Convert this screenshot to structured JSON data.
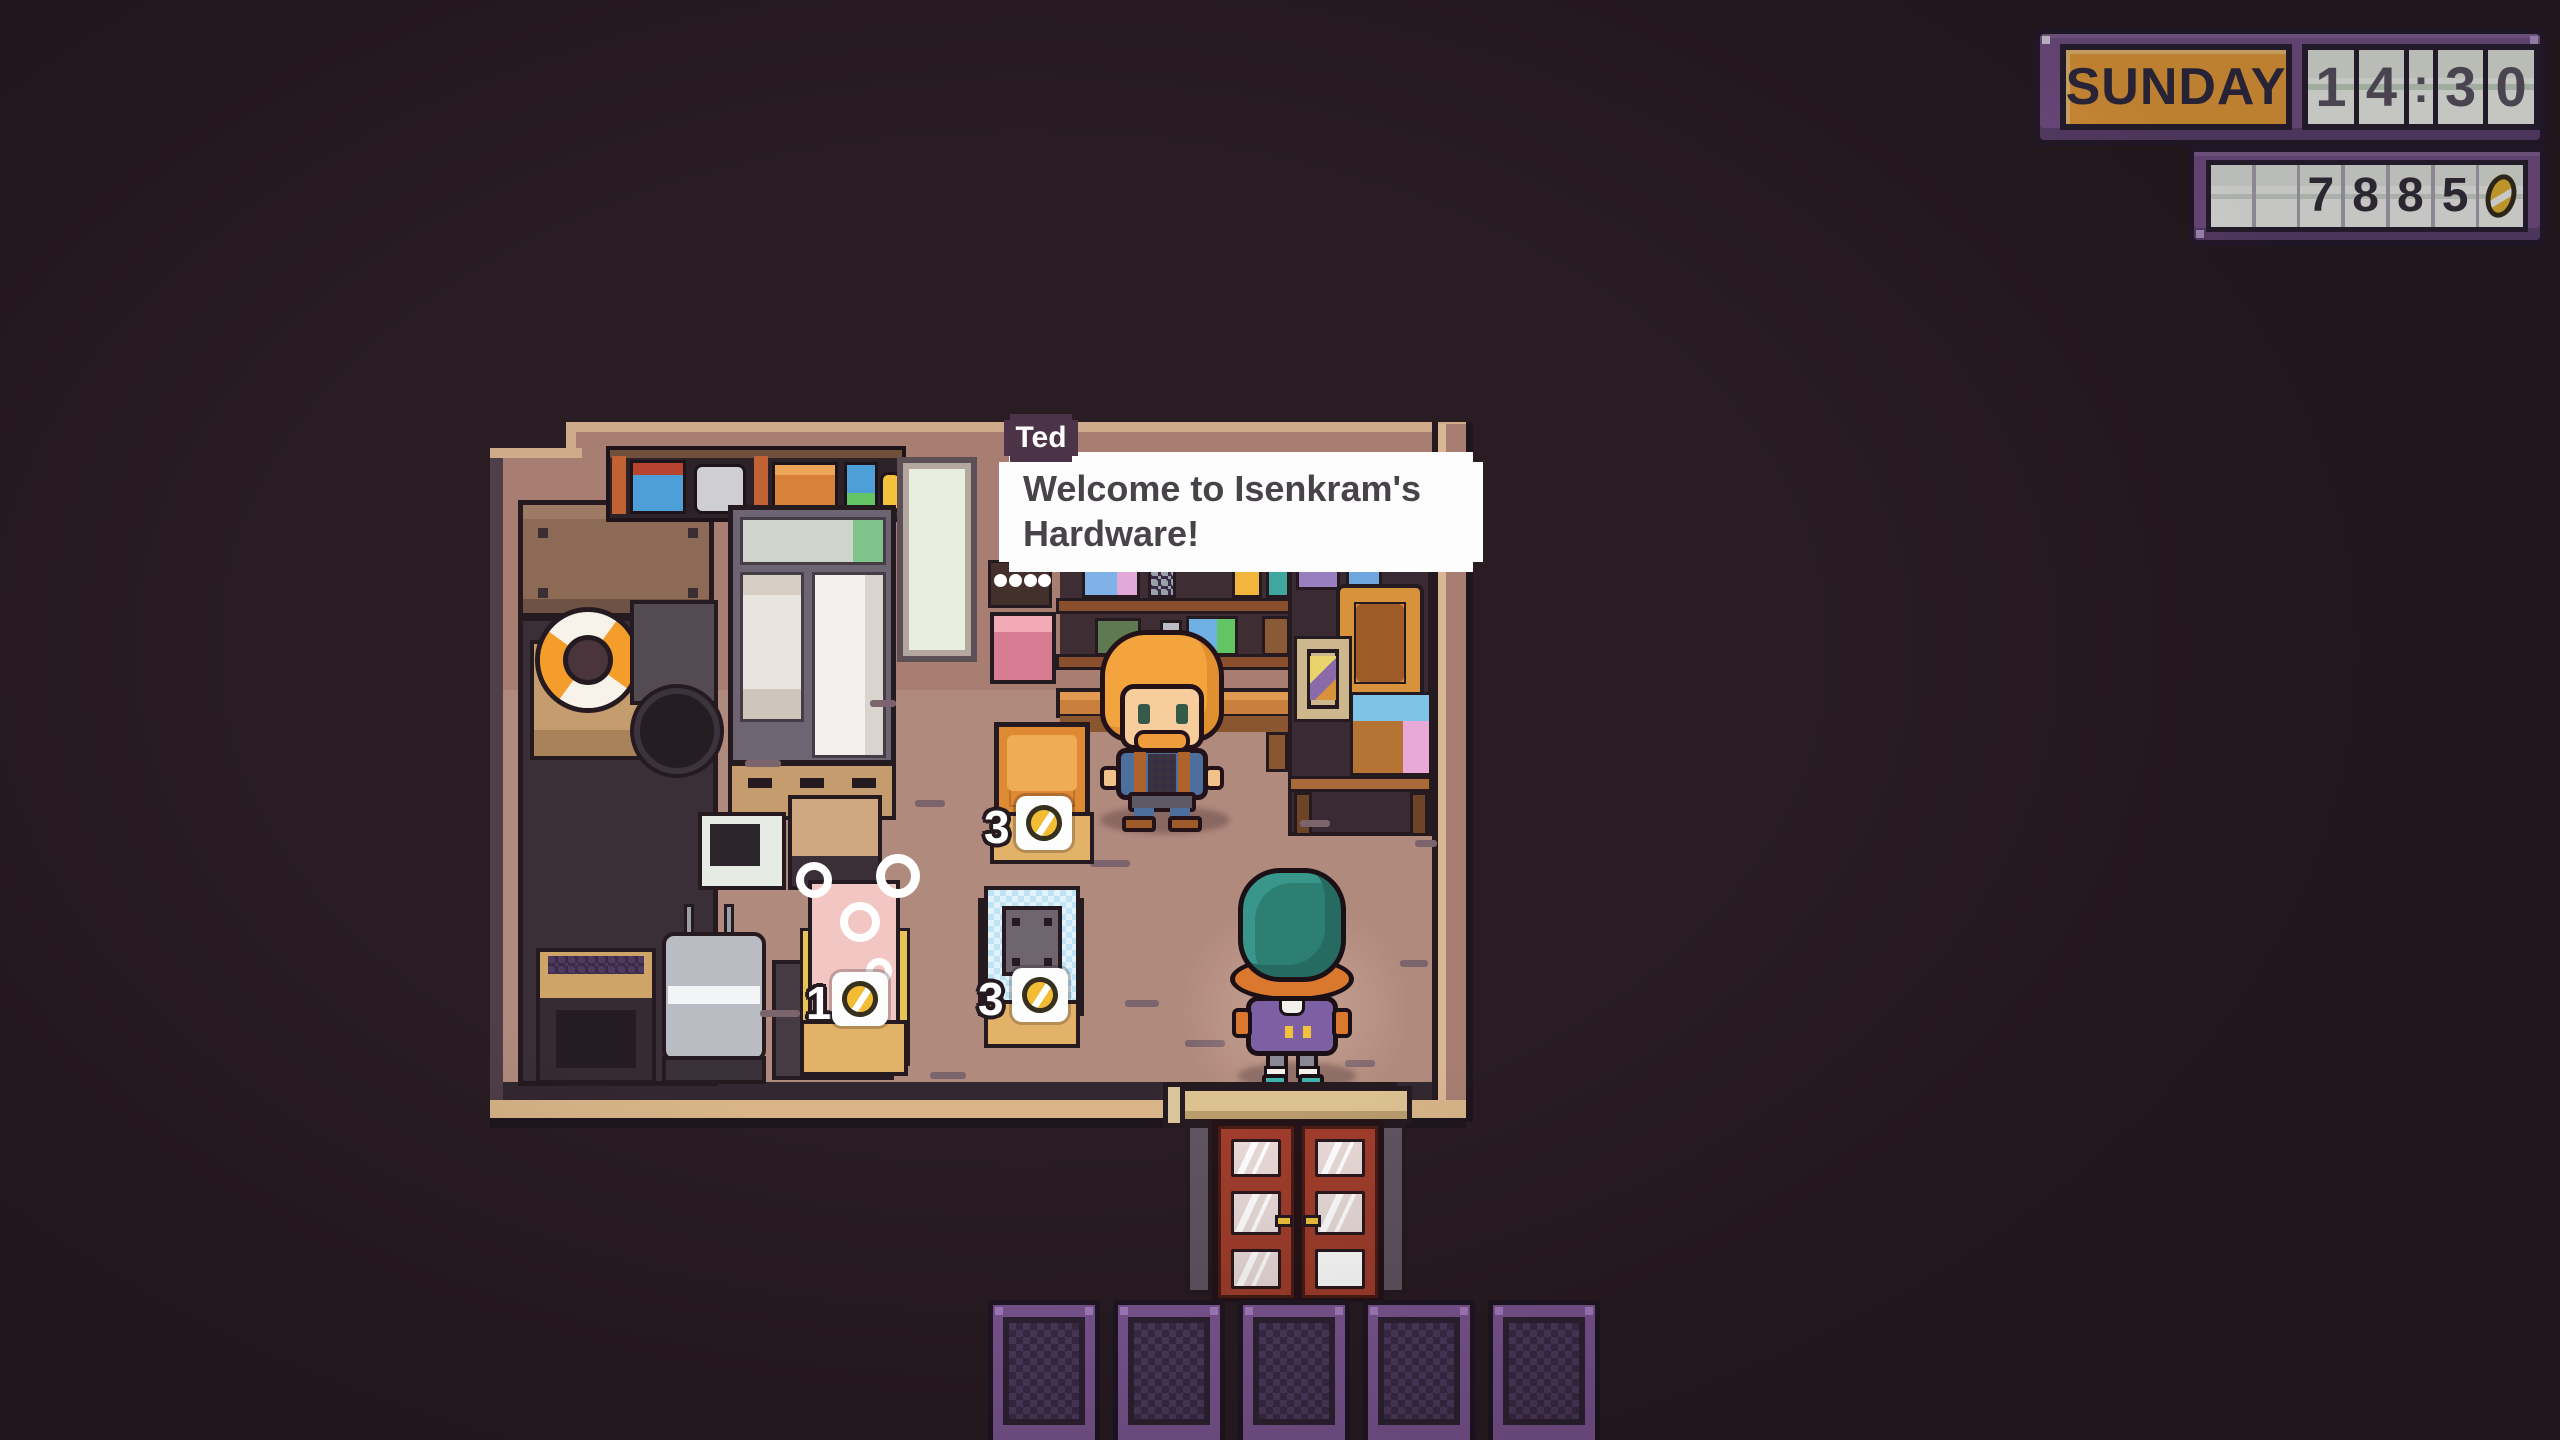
{
  "hud": {
    "day_label": "SUNDAY",
    "time_value": "14:30",
    "time_digits": [
      "1",
      "4",
      ":",
      "3",
      "0"
    ],
    "money_value": "7885",
    "money_digits": [
      "",
      "",
      "7",
      "8",
      "8",
      "5"
    ],
    "currency_icon": "coin-icon",
    "colors": {
      "panel_purple": "#7b5590",
      "day_bg_orange": "#f2a43f",
      "time_digit": "#5f5768",
      "money_digit": "#38313f",
      "coin_gold": "#f2bd35"
    }
  },
  "dialog": {
    "speaker_name": "Ted",
    "lines": [
      "Welcome to Isenkram's",
      "Hardware!"
    ]
  },
  "scene": {
    "location_name": "Isenkram's Hardware shop interior",
    "npc_name": "Ted",
    "shop_items": [
      {
        "name": "orange-crate",
        "price": "3"
      },
      {
        "name": "pink-bathtub",
        "price": "1"
      },
      {
        "name": "blue-washing-machine",
        "price": "3"
      }
    ],
    "colors": {
      "wall_mauve": "#a87e72",
      "floor_rose": "#b18a7e",
      "door_red": "#a03d2c",
      "fence_purple": "#7e5794",
      "background_dark": "#291c23"
    }
  }
}
